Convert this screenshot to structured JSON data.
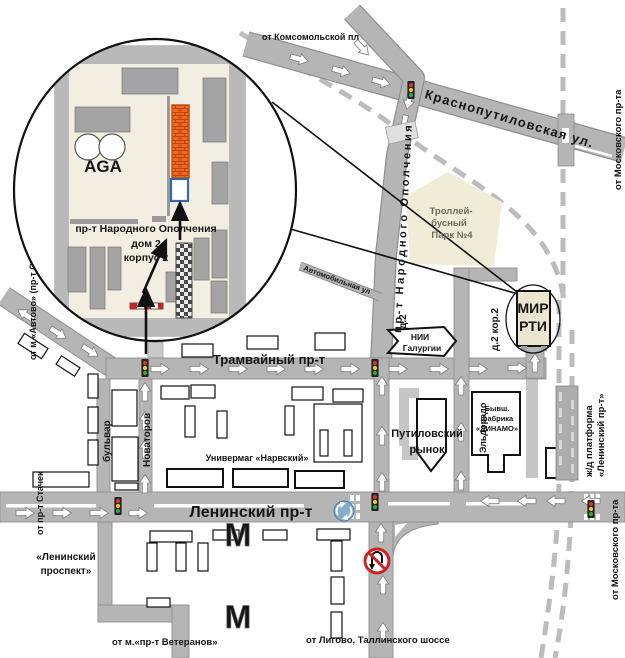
{
  "colors": {
    "street": "#b5b5b5",
    "street_edge": "#8f8f8f",
    "railway": "#bcbcbc",
    "inset_block": "#f2efe2",
    "trolley_park": "#f1ecd8",
    "building_gray": "#a3a3a3",
    "target_orange": "#ed6a1e",
    "destination_blue": "#3a66b0",
    "mir_rti_fill": "#ece5d0",
    "metro_gray": "#9d9d9d",
    "sign_red": "#cc2222",
    "sign_blue": "#85aecd",
    "traffic_red": "#e03131",
    "traffic_yellow": "#f5c518",
    "traffic_green": "#2faa3d"
  },
  "inset": {
    "aga": "AGA",
    "address_line1": "пр-т Народного Ополчения",
    "address_line2": "дом 2",
    "address_line3": "корпус 2"
  },
  "streets": {
    "krasnoputilovskaya": "Краснопутиловская ул.",
    "opolcheniya": "пр-т Народного Ополчения",
    "tramvayny": "Трамвайный пр-т",
    "leninsky": "Ленинский пр-т",
    "avtomobilnaya": "Автомобильная ул",
    "bulvar": "бульвар",
    "novatorov": "Новаторов"
  },
  "directions": {
    "komsomolskaya": "от Комсомольской пл",
    "moskovsky_top": "от Московского пр-та",
    "moskovsky_bottom": "от Московского пр-та",
    "avtovo": "от м.«Автово» (пр-т Стачек)",
    "stachek": "от пр-т Стачек",
    "veteranov": "от м.«пр-т Ветеранов»",
    "ligovo": "от Лигово, Таллинского шоссе"
  },
  "places": {
    "trolley_park": [
      "Троллей-",
      "бусный",
      "Парк №4"
    ],
    "nii": [
      "НИИ",
      "Галургии"
    ],
    "mir_rti": [
      "МИР",
      "РТИ"
    ],
    "univermag": "Универмаг «Нарвский»",
    "rynok": [
      "Путиловский",
      "рынок"
    ],
    "dinamo": [
      "Бывш.",
      "фабрика",
      "«ДИНАМО»"
    ],
    "eldorado": "Эльдорадо",
    "platform": [
      "ж/д платформа",
      "«Ленинский пр-т»"
    ],
    "metro_station": [
      "«Ленинский",
      "проспект»"
    ],
    "d2": "д.2",
    "d2k2": "д.2 кор.2"
  },
  "icons": {
    "metro_m": "М"
  }
}
